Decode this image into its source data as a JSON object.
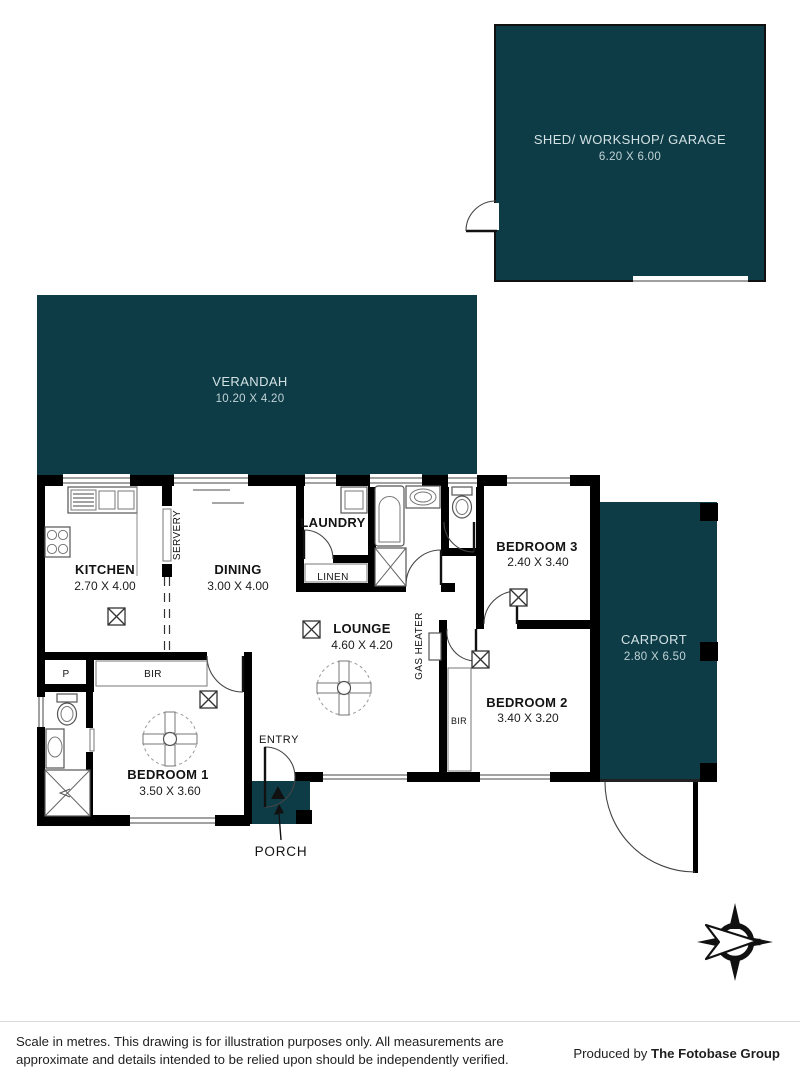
{
  "colors": {
    "teal": "#0d3c47",
    "wall": "#000000",
    "teal_text": "#d3e1e3",
    "teal_dims": "#c0d3d6"
  },
  "outdoor": {
    "shed": {
      "name": "SHED/ WORKSHOP/ GARAGE",
      "dims": "6.20 X 6.00"
    },
    "verandah": {
      "name": "VERANDAH",
      "dims": "10.20 X 4.20"
    },
    "carport": {
      "name": "CARPORT",
      "dims": "2.80 X 6.50"
    },
    "porch": {
      "label": "PORCH"
    }
  },
  "rooms": {
    "kitchen": {
      "name": "KITCHEN",
      "dims": "2.70 X 4.00"
    },
    "dining": {
      "name": "DINING",
      "dims": "3.00 X 4.00"
    },
    "laundry": {
      "name": "LAUNDRY"
    },
    "lounge": {
      "name": "LOUNGE",
      "dims": "4.60 X 4.20"
    },
    "bedroom1": {
      "name": "BEDROOM 1",
      "dims": "3.50 X 3.60"
    },
    "bedroom2": {
      "name": "BEDROOM 2",
      "dims": "3.40 X 3.20"
    },
    "bedroom3": {
      "name": "BEDROOM 3",
      "dims": "2.40 X 3.40"
    }
  },
  "labels": {
    "linen": "LINEN",
    "servery": "SERVERY",
    "gas_heater": "GAS HEATER",
    "entry": "ENTRY",
    "pantry": "P",
    "bir_bedroom1": "BIR",
    "bir_bedroom2": "BIR"
  },
  "compass": {
    "north": "N"
  },
  "footer": {
    "line1": "Scale in metres. This drawing is for illustration purposes only. All measurements are",
    "line2": "approximate and details intended to be relied upon should be independently verified.",
    "produced_by": "Produced by ",
    "producer": "The Fotobase Group"
  }
}
